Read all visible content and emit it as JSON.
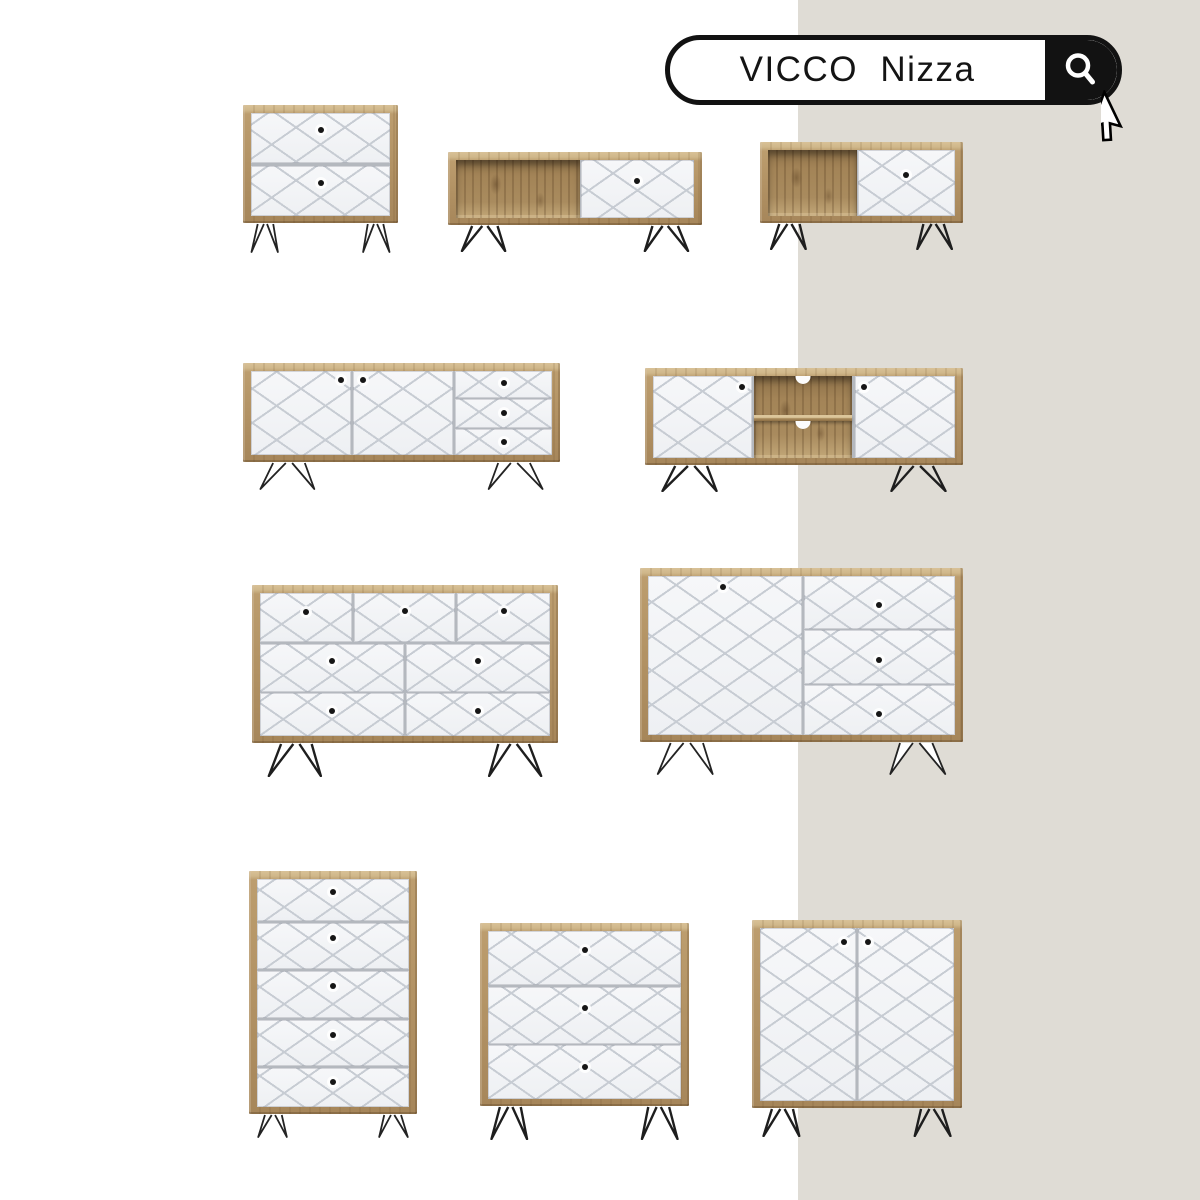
{
  "canvas": {
    "width": 1200,
    "height": 1200,
    "background_left": "#ffffff",
    "background_right": "#dfdcd5",
    "panel_split_x": 798
  },
  "search": {
    "query": "VICCO  Nizza",
    "icon": "magnifier-icon",
    "pill_border_color": "#121212",
    "button_color": "#121212",
    "text_color": "#141414"
  },
  "palette": {
    "wood_light": "#d8c197",
    "wood_mid": "#b19163",
    "wood_interior": "#a38457",
    "front_white": "#f4f5f7",
    "lattice_line": "#c7ccd3",
    "knob": "#161616",
    "leg": "#1e1e1e",
    "panel_gap": "#b4b8be"
  },
  "furniture": [
    {
      "id": "bedside-table-2-drawers",
      "x": 243,
      "y": 105,
      "w": 155,
      "h": 118,
      "legH": 30,
      "legs": "light",
      "panels": [
        {
          "kind": "drawer",
          "l": 0,
          "t": 0,
          "w": 100,
          "h": 49,
          "knobs": [
            [
              50,
              34
            ]
          ]
        },
        {
          "kind": "drawer",
          "l": 0,
          "t": 51,
          "w": 100,
          "h": 49,
          "knobs": [
            [
              50,
              34
            ]
          ]
        }
      ]
    },
    {
      "id": "coffee-table-open-shelf-drawer",
      "x": 448,
      "y": 152,
      "w": 254,
      "h": 73,
      "legH": 27,
      "legs": "dark",
      "panels": [
        {
          "kind": "open",
          "l": 0,
          "t": 0,
          "w": 52,
          "h": 100
        },
        {
          "kind": "drawer",
          "l": 52.5,
          "t": 0,
          "w": 47.5,
          "h": 100,
          "knobs": [
            [
              50,
              36
            ]
          ]
        }
      ]
    },
    {
      "id": "coffee-table-open-shelf-drawer-small",
      "x": 760,
      "y": 142,
      "w": 203,
      "h": 81,
      "legH": 27,
      "legs": "dark",
      "panels": [
        {
          "kind": "open",
          "l": 0,
          "t": 0,
          "w": 47.5,
          "h": 100
        },
        {
          "kind": "drawer",
          "l": 48,
          "t": 0,
          "w": 52,
          "h": 100,
          "knobs": [
            [
              50,
              38
            ]
          ]
        }
      ]
    },
    {
      "id": "sideboard-2-doors-3-drawers",
      "x": 243,
      "y": 363,
      "w": 317,
      "h": 99,
      "legH": 28,
      "legs": "light",
      "panels": [
        {
          "kind": "door",
          "l": 0,
          "t": 0,
          "w": 33.2,
          "h": 100,
          "knobs": [
            [
              90,
              11
            ]
          ]
        },
        {
          "kind": "door",
          "l": 33.9,
          "t": 0,
          "w": 33.2,
          "h": 100,
          "knobs": [
            [
              10,
              11
            ]
          ]
        },
        {
          "kind": "drawer",
          "l": 67.8,
          "t": 0,
          "w": 32.2,
          "h": 32.3,
          "knobs": [
            [
              50,
              44
            ]
          ]
        },
        {
          "kind": "drawer",
          "l": 67.8,
          "t": 33.3,
          "w": 32.2,
          "h": 35.1,
          "knobs": [
            [
              50,
              46
            ]
          ]
        },
        {
          "kind": "drawer",
          "l": 67.8,
          "t": 69.4,
          "w": 32.2,
          "h": 30.6,
          "knobs": [
            [
              50,
              50
            ]
          ]
        }
      ]
    },
    {
      "id": "tv-lowboard-2-doors-open-shelves",
      "x": 645,
      "y": 368,
      "w": 318,
      "h": 97,
      "legH": 27,
      "legs": "dark",
      "panels": [
        {
          "kind": "door",
          "l": 0,
          "t": 0,
          "w": 32.8,
          "h": 100,
          "knobs": [
            [
              90,
              13
            ]
          ]
        },
        {
          "kind": "open",
          "l": 33.4,
          "t": 0,
          "w": 32.6,
          "h": 100,
          "shelf": true,
          "holes": true
        },
        {
          "kind": "door",
          "l": 66.8,
          "t": 0,
          "w": 33.2,
          "h": 100,
          "knobs": [
            [
              9,
              13
            ]
          ]
        }
      ]
    },
    {
      "id": "chest-7-drawers",
      "x": 252,
      "y": 585,
      "w": 306,
      "h": 158,
      "legH": 34,
      "legs": "dark",
      "panels": [
        {
          "kind": "drawer",
          "l": 0,
          "t": 0,
          "w": 31.8,
          "h": 34.6,
          "knobs": [
            [
              50,
              38
            ]
          ]
        },
        {
          "kind": "drawer",
          "l": 32.5,
          "t": 0,
          "w": 34.7,
          "h": 34.6,
          "knobs": [
            [
              50,
              37
            ]
          ]
        },
        {
          "kind": "drawer",
          "l": 68,
          "t": 0,
          "w": 32,
          "h": 34.6,
          "knobs": [
            [
              50,
              37
            ]
          ]
        },
        {
          "kind": "drawer",
          "l": 0,
          "t": 35.5,
          "w": 49.6,
          "h": 33.8,
          "knobs": [
            [
              50,
              36
            ]
          ]
        },
        {
          "kind": "drawer",
          "l": 50.4,
          "t": 35.5,
          "w": 49.6,
          "h": 33.8,
          "knobs": [
            [
              50,
              36
            ]
          ]
        },
        {
          "kind": "drawer",
          "l": 0,
          "t": 70.2,
          "w": 49.6,
          "h": 29.8,
          "knobs": [
            [
              50,
              42
            ]
          ]
        },
        {
          "kind": "drawer",
          "l": 50.4,
          "t": 70.2,
          "w": 49.6,
          "h": 29.8,
          "knobs": [
            [
              50,
              42
            ]
          ]
        }
      ]
    },
    {
      "id": "sideboard-1-door-3-drawers",
      "x": 640,
      "y": 568,
      "w": 323,
      "h": 174,
      "legH": 33,
      "legs": "light",
      "panels": [
        {
          "kind": "door",
          "l": 0,
          "t": 0,
          "w": 50,
          "h": 100,
          "knobs": [
            [
              49,
              7
            ]
          ]
        },
        {
          "kind": "drawer",
          "l": 50.8,
          "t": 0,
          "w": 49.2,
          "h": 33.5,
          "knobs": [
            [
              50,
              54
            ]
          ]
        },
        {
          "kind": "drawer",
          "l": 50.8,
          "t": 34.2,
          "w": 49.2,
          "h": 33.5,
          "knobs": [
            [
              50,
              55
            ]
          ]
        },
        {
          "kind": "drawer",
          "l": 50.8,
          "t": 68.4,
          "w": 49.2,
          "h": 31.6,
          "knobs": [
            [
              50,
              58
            ]
          ]
        }
      ]
    },
    {
      "id": "tall-chest-5-drawers",
      "x": 249,
      "y": 871,
      "w": 168,
      "h": 243,
      "legH": 24,
      "legs": "light",
      "panels": [
        {
          "kind": "drawer",
          "l": 0,
          "t": 0,
          "w": 100,
          "h": 18.4,
          "knobs": [
            [
              50,
              32
            ]
          ]
        },
        {
          "kind": "drawer",
          "l": 0,
          "t": 19.4,
          "w": 100,
          "h": 20,
          "knobs": [
            [
              50,
              32
            ]
          ]
        },
        {
          "kind": "drawer",
          "l": 0,
          "t": 40.4,
          "w": 100,
          "h": 20.5,
          "knobs": [
            [
              50,
              32
            ]
          ]
        },
        {
          "kind": "drawer",
          "l": 0,
          "t": 61.9,
          "w": 100,
          "h": 20.1,
          "knobs": [
            [
              50,
              32
            ]
          ]
        },
        {
          "kind": "drawer",
          "l": 0,
          "t": 83,
          "w": 100,
          "h": 17,
          "knobs": [
            [
              50,
              35
            ]
          ]
        }
      ]
    },
    {
      "id": "chest-3-drawers",
      "x": 480,
      "y": 923,
      "w": 209,
      "h": 183,
      "legH": 34,
      "legs": "dark",
      "panels": [
        {
          "kind": "drawer",
          "l": 0,
          "t": 0,
          "w": 100,
          "h": 32.2,
          "knobs": [
            [
              50,
              36
            ]
          ]
        },
        {
          "kind": "drawer",
          "l": 0,
          "t": 33.1,
          "w": 100,
          "h": 34,
          "knobs": [
            [
              50,
              38
            ]
          ]
        },
        {
          "kind": "drawer",
          "l": 0,
          "t": 68.1,
          "w": 100,
          "h": 31.9,
          "knobs": [
            [
              50,
              40
            ]
          ]
        }
      ]
    },
    {
      "id": "cabinet-2-doors",
      "x": 752,
      "y": 920,
      "w": 210,
      "h": 188,
      "legH": 29,
      "legs": "dark",
      "panels": [
        {
          "kind": "door",
          "l": 0,
          "t": 0,
          "w": 49.6,
          "h": 100,
          "knobs": [
            [
              87,
              8
            ]
          ]
        },
        {
          "kind": "door",
          "l": 50.4,
          "t": 0,
          "w": 49.6,
          "h": 100,
          "knobs": [
            [
              11,
              8
            ]
          ]
        }
      ]
    }
  ]
}
